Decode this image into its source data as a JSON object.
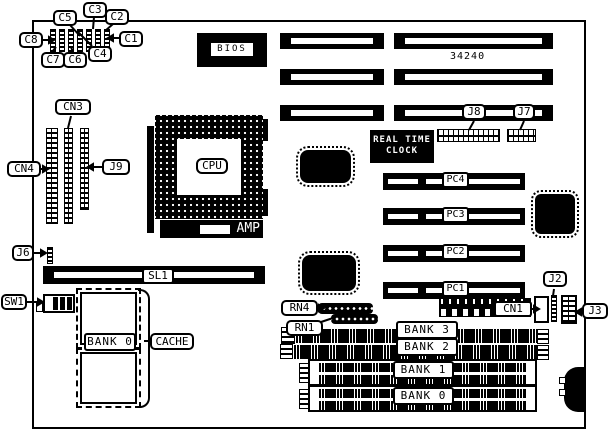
{
  "labels": {
    "c1": "C1",
    "c2": "C2",
    "c3": "C3",
    "c4": "C4",
    "c5": "C5",
    "c6": "C6",
    "c7": "C7",
    "c8": "C8",
    "cn3": "CN3",
    "cn4": "CN4",
    "j9": "J9",
    "j6": "J6",
    "j8": "J8",
    "j7": "J7",
    "j2": "J2",
    "j3": "J3",
    "cn1": "CN1",
    "sw1": "SW1",
    "sl1": "SL1",
    "rn4": "RN4",
    "rn1": "RN1",
    "cpu": "CPU",
    "amp": "AMP",
    "bios": "BIOS",
    "part_number": "34240",
    "rtc_line1": "REAL TIME",
    "rtc_line2": "CLOCK",
    "pc4": "PC4",
    "pc3": "PC3",
    "pc2": "PC2",
    "pc1": "PC1",
    "cache": "CACHE",
    "cache_bank": "BANK 0",
    "bank3": "BANK 3",
    "bank2": "BANK 2",
    "bank1": "BANK 1",
    "bank0": "BANK 0"
  },
  "colors": {
    "ink": "#000000",
    "paper": "#ffffff"
  }
}
